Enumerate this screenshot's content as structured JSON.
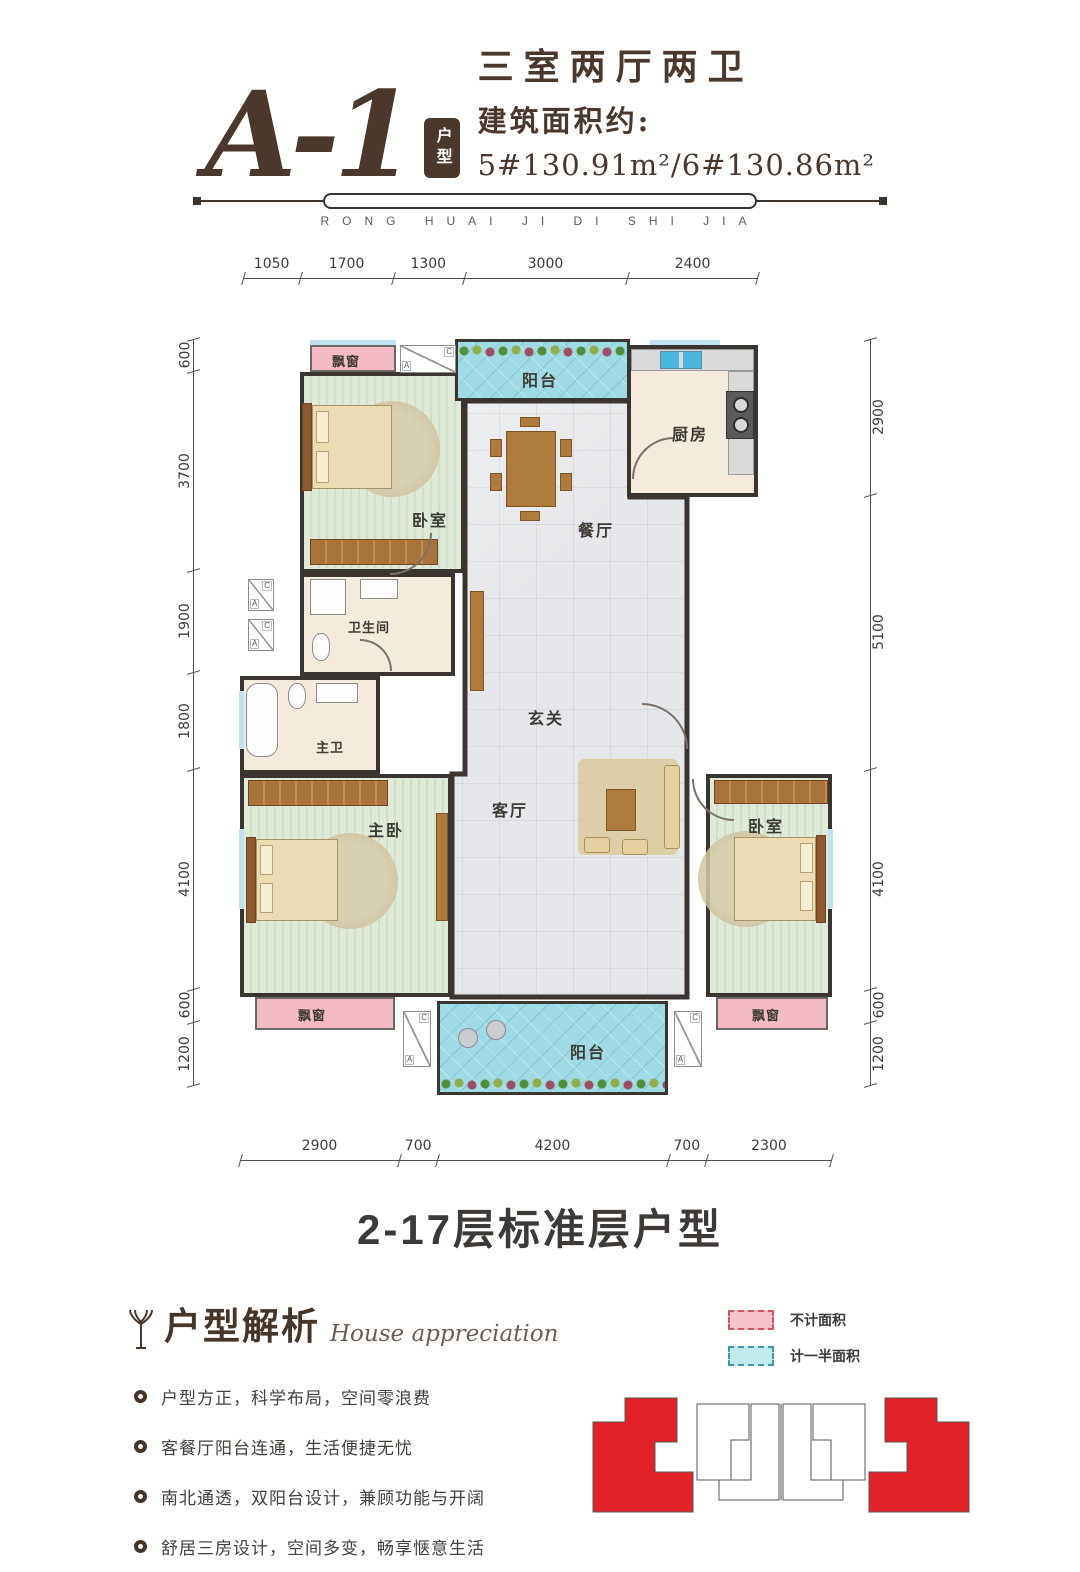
{
  "header": {
    "unit_code": "A-1",
    "unit_badge": "户型",
    "layout_type": "三室两厅两卫",
    "area_label": "建筑面积约:",
    "area_value": "5#130.91m²/6#130.86m²",
    "brand_letters": "RONG HUAI JI DI SHI JIA"
  },
  "plan": {
    "rooms": {
      "bay_top": "飘窗",
      "balcony_top": "阳台",
      "kitchen": "厨房",
      "bedroom_top": "卧室",
      "dining": "餐厅",
      "bath": "卫生间",
      "master_bath": "主卫",
      "foyer": "玄关",
      "master_bedroom": "主卧",
      "living": "客厅",
      "bedroom_right": "卧室",
      "bay_bottom_left": "飘窗",
      "bay_bottom_right": "飘窗",
      "balcony_bottom": "阳台"
    },
    "ac_a": "A",
    "ac_c": "C"
  },
  "dimensions": {
    "top": [
      "1050",
      "1700",
      "1300",
      "3000",
      "2400"
    ],
    "left": [
      "600",
      "3700",
      "1900",
      "1800",
      "4100",
      "600",
      "1200"
    ],
    "right": [
      "2900",
      "5100",
      "4100",
      "600",
      "1200"
    ],
    "bottom": [
      "2900",
      "700",
      "4200",
      "700",
      "2300"
    ]
  },
  "caption": "2-17层标准层户型",
  "analysis": {
    "title": "户型解析",
    "subtitle": "House appreciation",
    "bullets": [
      "户型方正，科学布局，空间零浪费",
      "客餐厅阳台连通，生活便捷无忧",
      "南北通透，双阳台设计，兼顾功能与开阔",
      "舒居三房设计，空间多变，畅享惬意生活",
      "独立主卧空间，尊享私密与尊贵"
    ]
  },
  "legend": {
    "items": [
      {
        "label": "不计面积"
      },
      {
        "label": "计一半面积"
      }
    ]
  },
  "footprint": {
    "highlight_color": "#e32227"
  }
}
